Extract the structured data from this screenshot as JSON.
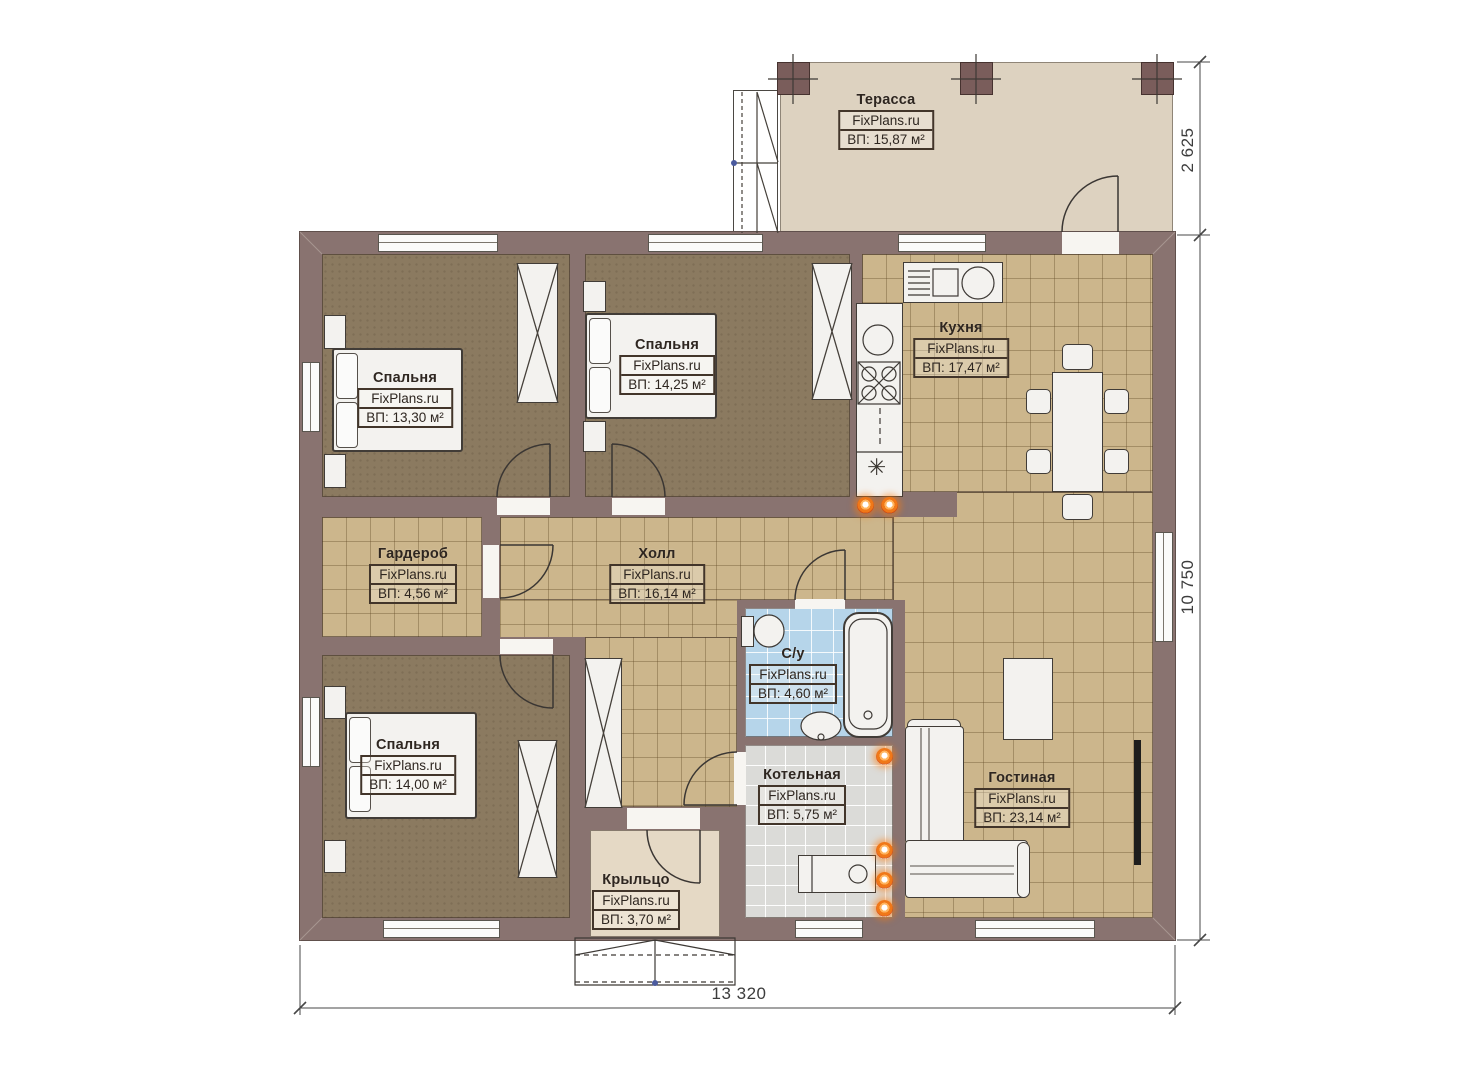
{
  "watermark": "FixPlans.ru",
  "rooms": [
    {
      "id": "terrace",
      "name": "Терасса",
      "watermark": "FixPlans.ru",
      "area": "ВП: 15,87 м²"
    },
    {
      "id": "bedroom1",
      "name": "Спальня",
      "watermark": "FixPlans.ru",
      "area": "ВП: 13,30 м²"
    },
    {
      "id": "bedroom2",
      "name": "Спальня",
      "watermark": "FixPlans.ru",
      "area": "ВП: 14,25 м²"
    },
    {
      "id": "kitchen",
      "name": "Кухня",
      "watermark": "FixPlans.ru",
      "area": "ВП: 17,47 м²"
    },
    {
      "id": "wardrobe",
      "name": "Гардероб",
      "watermark": "FixPlans.ru",
      "area": "ВП: 4,56 м²"
    },
    {
      "id": "hall",
      "name": "Холл",
      "watermark": "FixPlans.ru",
      "area": "ВП: 16,14 м²"
    },
    {
      "id": "bathroom",
      "name": "С/у",
      "watermark": "FixPlans.ru",
      "area": "ВП: 4,60 м²"
    },
    {
      "id": "bedroom3",
      "name": "Спальня",
      "watermark": "FixPlans.ru",
      "area": "ВП: 14,00 м²"
    },
    {
      "id": "boiler",
      "name": "Котельная",
      "watermark": "FixPlans.ru",
      "area": "ВП: 5,75 м²"
    },
    {
      "id": "living",
      "name": "Гостиная",
      "watermark": "FixPlans.ru",
      "area": "ВП: 23,14 м²"
    },
    {
      "id": "porch",
      "name": "Крыльцо",
      "watermark": "FixPlans.ru",
      "area": "ВП: 3,70 м²"
    }
  ],
  "dimensions": {
    "terrace_depth": "2 625",
    "house_depth": "10 750",
    "house_width": "13 320"
  },
  "icons": {
    "fridge_snowflake": "✳"
  },
  "colors": {
    "wall": "#897370",
    "column": "#7a5d5b",
    "tile_tan": "#ccb68c",
    "bedroom_floor": "#8b7a60",
    "bathroom_tile": "#b6d5ea",
    "boiler_tile": "#dbdbd8",
    "terrace_floor": "#ddd2c0",
    "porch_floor": "#e5d9c5",
    "radiator_orange": "#f07818"
  }
}
